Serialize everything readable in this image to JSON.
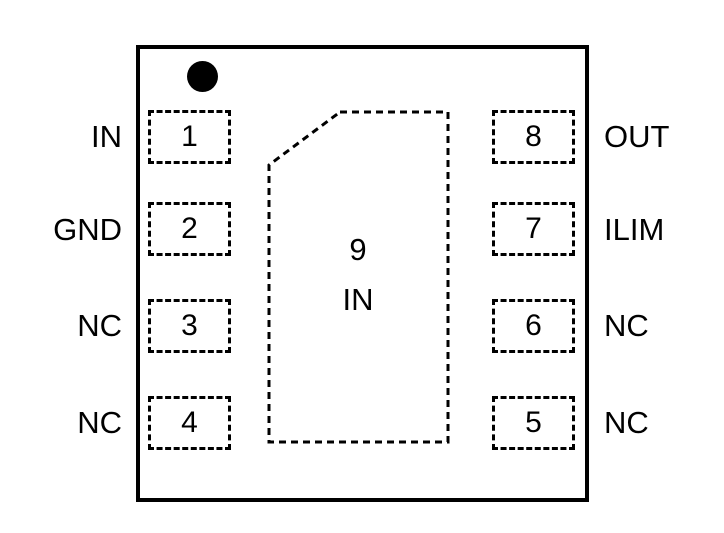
{
  "diagram": {
    "type": "ic-package-pinout",
    "pin_count_visible": 9,
    "colors": {
      "line": "#000000",
      "text": "#000000",
      "background": "#ffffff"
    },
    "pins": {
      "left": [
        {
          "number": "1",
          "label": "IN"
        },
        {
          "number": "2",
          "label": "GND"
        },
        {
          "number": "3",
          "label": "NC"
        },
        {
          "number": "4",
          "label": "NC"
        }
      ],
      "right": [
        {
          "number": "8",
          "label": "OUT"
        },
        {
          "number": "7",
          "label": "ILIM"
        },
        {
          "number": "6",
          "label": "NC"
        },
        {
          "number": "5",
          "label": "NC"
        }
      ]
    },
    "center_pad": {
      "number": "9",
      "label": "IN"
    }
  }
}
